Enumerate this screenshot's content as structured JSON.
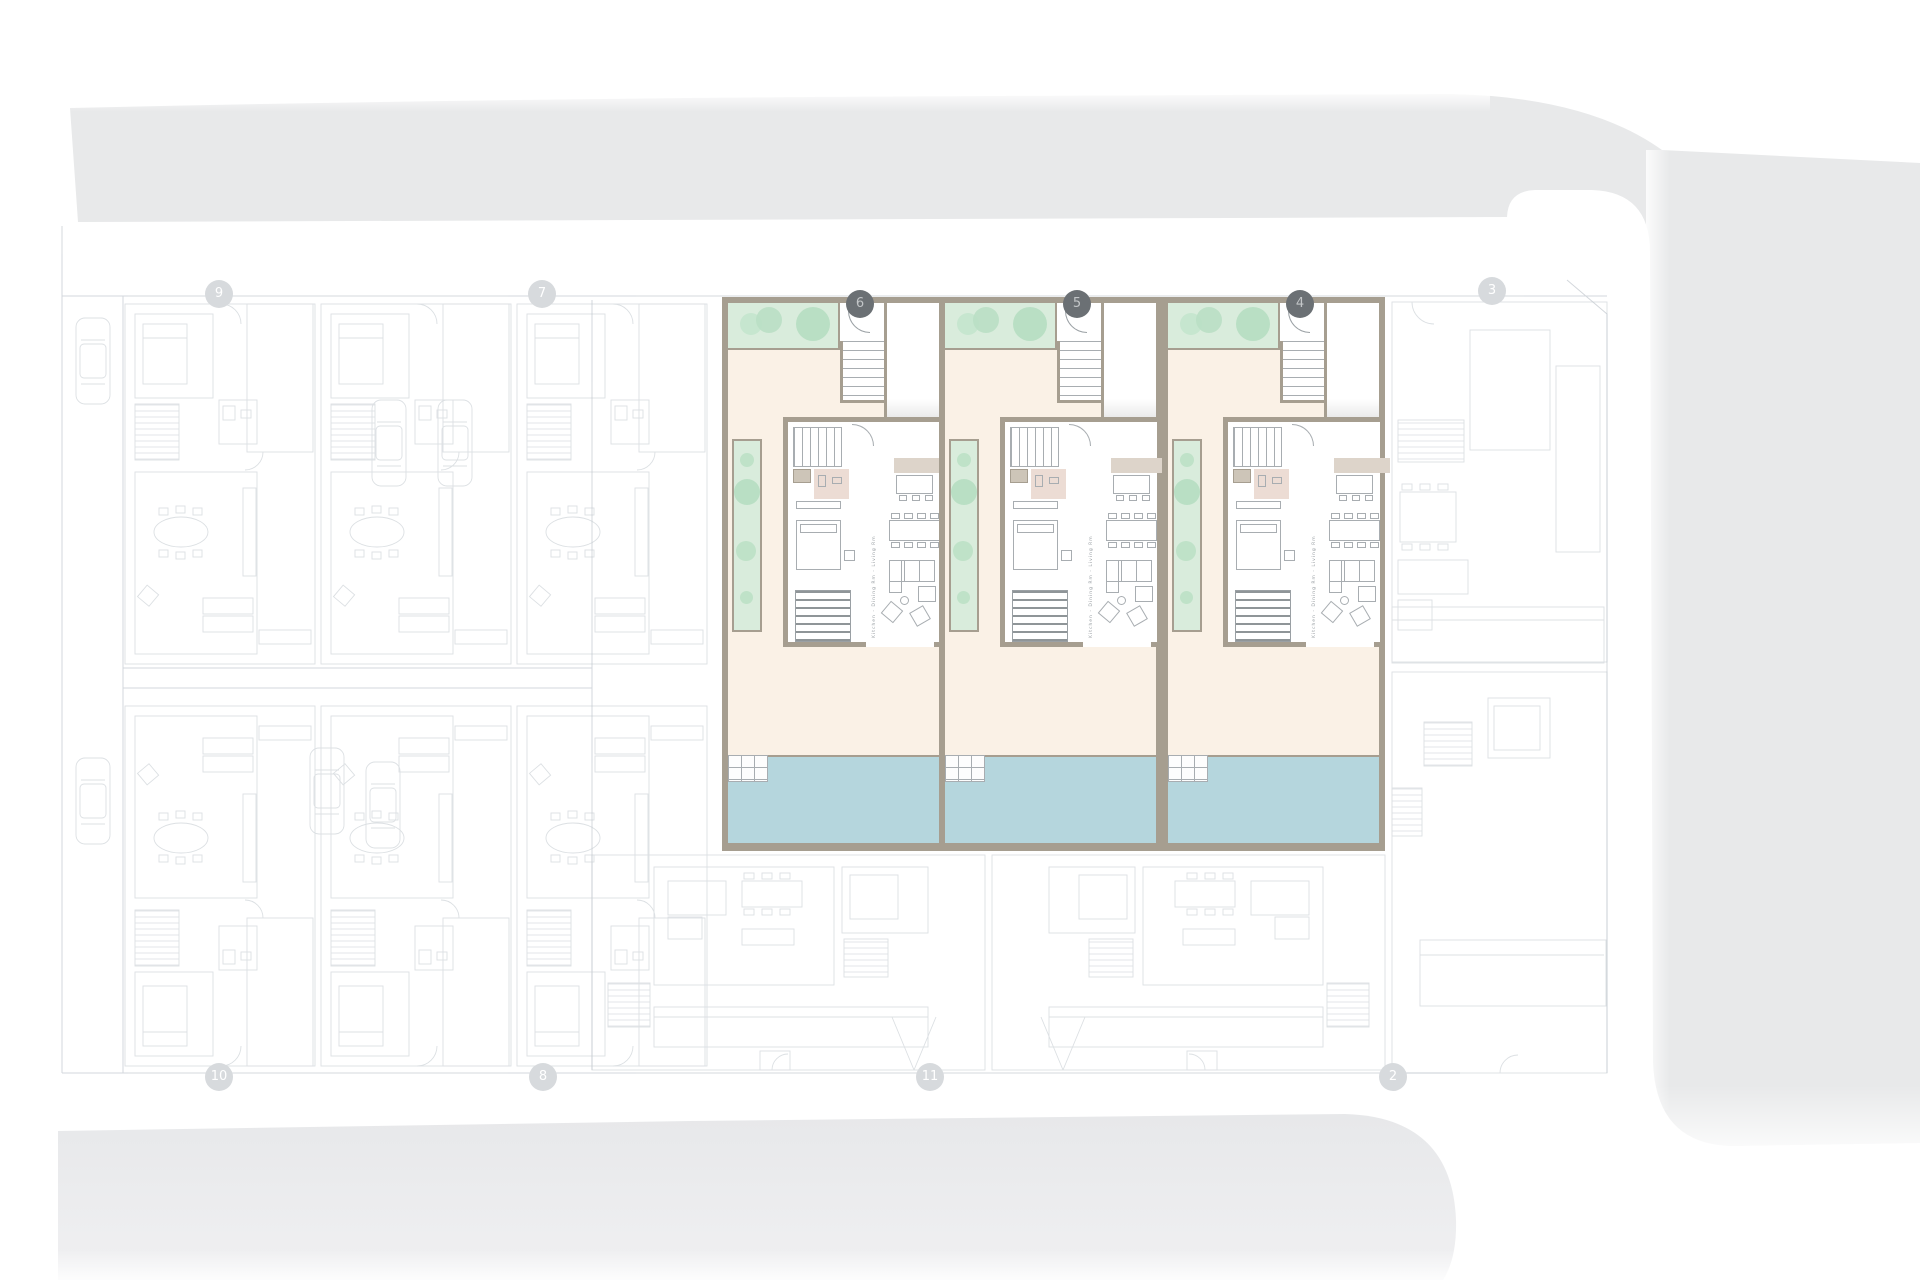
{
  "colors": {
    "highlight_wall": "#a69e90",
    "courtyard_cream": "#faf1e6",
    "garden_green": "#d9ecdc",
    "tree_green": "#b9dfc4",
    "pool_blue": "#b5d6dd",
    "kitchen_beige": "#ddd4ca",
    "bath_pink": "#ecdcd4",
    "road_gray": "#e8e9ea",
    "faded_line_gray": "#bfc6cc",
    "marker_active_bg": "#6b7074",
    "marker_faded_bg": "#d7dadd"
  },
  "highlighted_units": [
    {
      "number": "6",
      "x": 722
    },
    {
      "number": "5",
      "x": 939
    },
    {
      "number": "4",
      "x": 1162
    }
  ],
  "unit_room_label": "Kitchen - Dining Rm - Living Rm",
  "markers": [
    {
      "label": "9",
      "x": 219,
      "y": 294,
      "state": "faded"
    },
    {
      "label": "7",
      "x": 542,
      "y": 294,
      "state": "faded"
    },
    {
      "label": "3",
      "x": 1492,
      "y": 291,
      "state": "faded"
    },
    {
      "label": "10",
      "x": 219,
      "y": 1077,
      "state": "faded"
    },
    {
      "label": "8",
      "x": 543,
      "y": 1077,
      "state": "faded"
    },
    {
      "label": "11",
      "x": 930,
      "y": 1077,
      "state": "faded"
    },
    {
      "label": "2",
      "x": 1393,
      "y": 1077,
      "state": "faded"
    }
  ]
}
